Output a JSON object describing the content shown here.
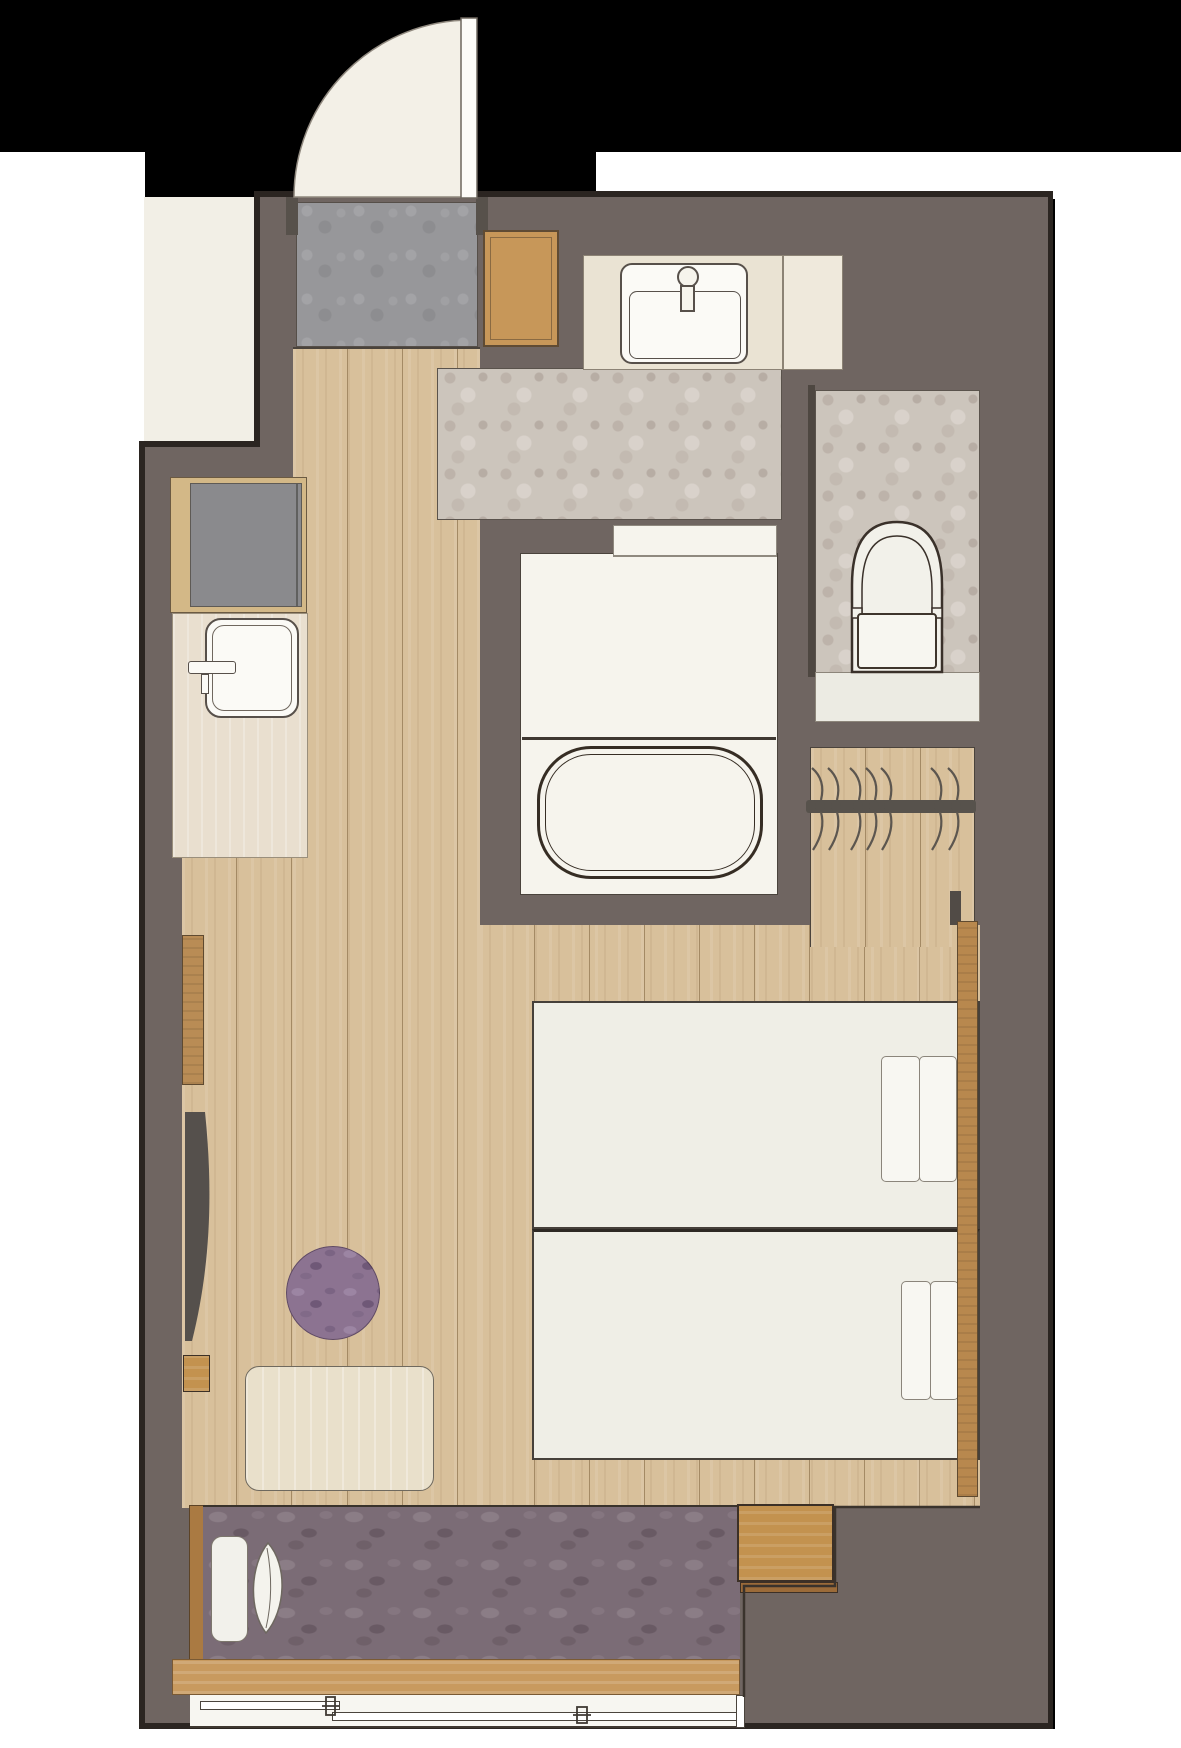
{
  "meta": {
    "title": "Hotel twin room floor plan",
    "type": "architectural floor plan, top-down view",
    "visible_text": "none"
  },
  "canvas": {
    "width": 1181,
    "height": 1748,
    "background": "#000000"
  },
  "palette": {
    "background_black": "#000000",
    "exterior_white": "#ffffff",
    "hallway_cream": "#f2efe6",
    "wall_taupe": "#6f6561",
    "wall_outline": "#2b2521",
    "wood_floor": "#d8c09b",
    "entry_tile_gray": "#97979a",
    "wet_area_tile": "#ccc5bc",
    "bath_white": "#f6f4ed",
    "bed_linen": "#efeee6",
    "carpet_purple": "#7b6c76",
    "ottoman_purple": "#8c7391",
    "furniture_wood": "#c3924f",
    "headboard_wood": "#b8884e",
    "tv_dark": "#55504c"
  },
  "rooms": {
    "exterior": {
      "label": "Exterior / surrounding area"
    },
    "hallway": {
      "label": "Hallway outside room"
    },
    "entry": {
      "label": "Entrance (genkan) with gray tile"
    },
    "corridor": {
      "label": "Entry corridor, wood flooring"
    },
    "washroom": {
      "label": "Washroom with vanity basin"
    },
    "bathroom": {
      "label": "Unit bath with tub"
    },
    "toilet": {
      "label": "Separate toilet room"
    },
    "closet": {
      "label": "Open closet with hanger rail"
    },
    "bedroom": {
      "label": "Bedroom, wood flooring"
    },
    "window_side": {
      "label": "Window-side carpeted bench"
    }
  },
  "fixtures": {
    "entrance_door": {
      "label": "Entrance door, 90-degree outward swing"
    },
    "shoe_cabinet": {
      "label": "Shoe cabinet"
    },
    "refrigerator": {
      "label": "Mini refrigerator cabinet"
    },
    "counter_sink": {
      "label": "Counter sink with faucet"
    },
    "vanity_sink": {
      "label": "Vanity washbasin with faucet"
    },
    "bathtub": {
      "label": "Bathtub"
    },
    "bath_door": {
      "label": "Bathroom door"
    },
    "toilet_fixture": {
      "label": "Toilet with tank"
    },
    "hanger_rail": {
      "label": "Closet hanger rail",
      "hanger_count": 7
    },
    "window": {
      "label": "Sliding window, two panes"
    },
    "window_sill": {
      "label": "Window sill ledge"
    }
  },
  "furniture": {
    "twin_bed_1": {
      "label": "Twin bed 1 (upper)",
      "pillows": 2
    },
    "twin_bed_2": {
      "label": "Twin bed 2 (lower)",
      "pillows": 2
    },
    "headboard": {
      "label": "Shared wood headboard panel"
    },
    "tv": {
      "label": "Wall-mounted TV"
    },
    "tv_console": {
      "label": "Wall wood panel / console"
    },
    "wood_stool": {
      "label": "Small wood stool"
    },
    "ottoman": {
      "label": "Round purple ottoman"
    },
    "table": {
      "label": "Low table / desk"
    },
    "bench_cushion": {
      "label": "Bench seat cushion"
    },
    "bench_pillow": {
      "label": "Bench pillow"
    },
    "step_table": {
      "label": "Wood step / side table at bench end"
    }
  },
  "counts": {
    "beds": 2,
    "pillows": 4,
    "hangers": 7,
    "window_panes": 2
  }
}
